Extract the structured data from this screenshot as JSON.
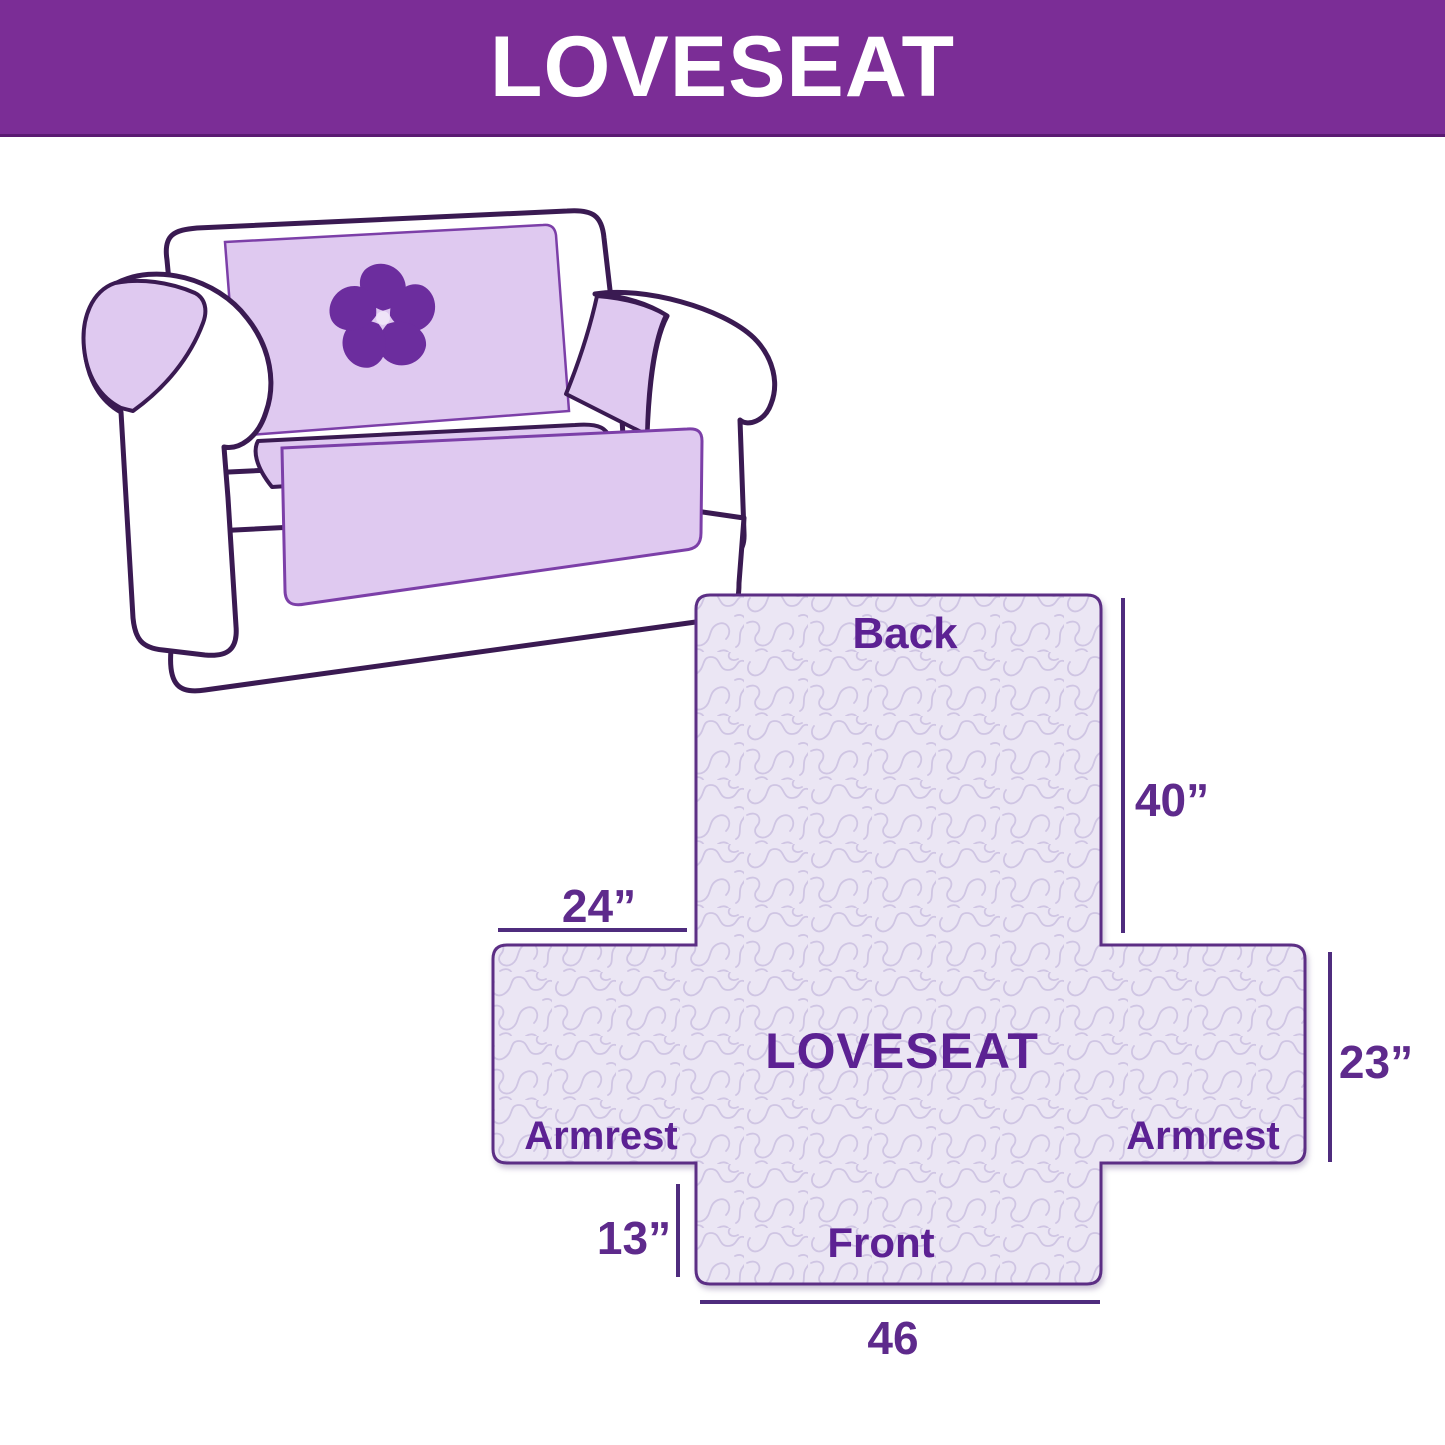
{
  "banner": {
    "title": "LOVESEAT"
  },
  "sofa": {
    "description": "loveseat sofa sketch with quilted furniture cover draped over back, seat and armrests",
    "logo_icon": "pinwheel-icon"
  },
  "diagram": {
    "center_label": "LOVESEAT",
    "labels": {
      "back": "Back",
      "front": "Front",
      "armrest_left": "Armrest",
      "armrest_right": "Armrest"
    },
    "dimensions": {
      "back_height": "40”",
      "back_left_offset": "24”",
      "side_depth": "23”",
      "front_drop": "13”",
      "front_width": "46"
    }
  },
  "colors": {
    "banner_bg": "#7B2D96",
    "banner_text": "#FFFFFF",
    "outline_dark": "#3A1A52",
    "diagram_border": "#5B2E85",
    "dimension_line": "#4F2C7E",
    "dimension_text": "#5E2A8C",
    "label_text": "#5C2193",
    "cover_fill": "#DFC9F0",
    "cover_stroke": "#7C3FA8",
    "pattern_bg": "#EBE6F4",
    "pattern_squiggle": "#CFC5E3",
    "logo_purple": "#6C2D9E"
  }
}
